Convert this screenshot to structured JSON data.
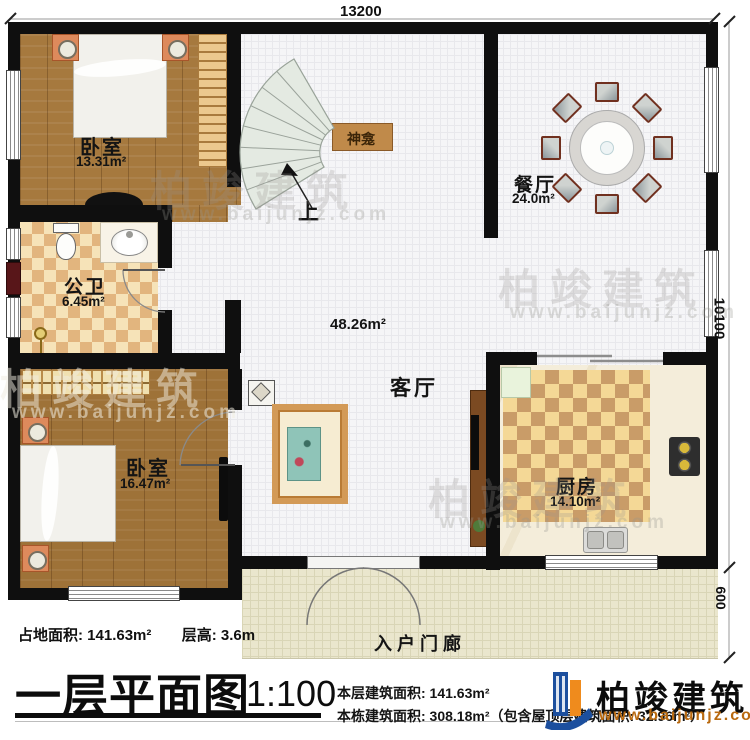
{
  "plan_title": "一层平面图",
  "dimensions": {
    "top_width": "13200",
    "right_height": "10100",
    "right_porch_depth": "600"
  },
  "rooms": {
    "bedroom1": {
      "name": "卧室",
      "area": "13.31m²"
    },
    "bathroom": {
      "name": "公卫",
      "area": "6.45m²"
    },
    "bedroom2": {
      "name": "卧室",
      "area": "16.47m²"
    },
    "shrine": {
      "name": "神龛"
    },
    "dining": {
      "name": "餐厅",
      "area": "24.0m²"
    },
    "living": {
      "name": "客厅",
      "area": "48.26m²"
    },
    "kitchen": {
      "name": "厨房",
      "area": "14.10m²"
    },
    "porch": {
      "name": "入户门廊"
    }
  },
  "stairs": {
    "up_label": "上"
  },
  "footer": {
    "site_area_label": "占地面积: 141.63m²",
    "floor_height_label": "层高: 3.6m",
    "title": "一层平面图",
    "scale": "1:100",
    "floor_area_label": "本层建筑面积: 141.63m²",
    "building_area_label": "本栋建筑面积: 308.18m²（包含屋顶层建筑面积: 32.96m²）"
  },
  "logo": {
    "name": "柏竣建筑",
    "website": "www.baijunjz.com"
  },
  "watermark": {
    "text": "柏竣建筑",
    "url": "www.baijunjz.com"
  },
  "colors": {
    "wall": "#0f0f0f",
    "logo_blue": "#1c4f9e",
    "logo_orange": "#ef8b1d",
    "bed_blue": "#68c2de",
    "shrine_brown": "#c08a4a"
  }
}
